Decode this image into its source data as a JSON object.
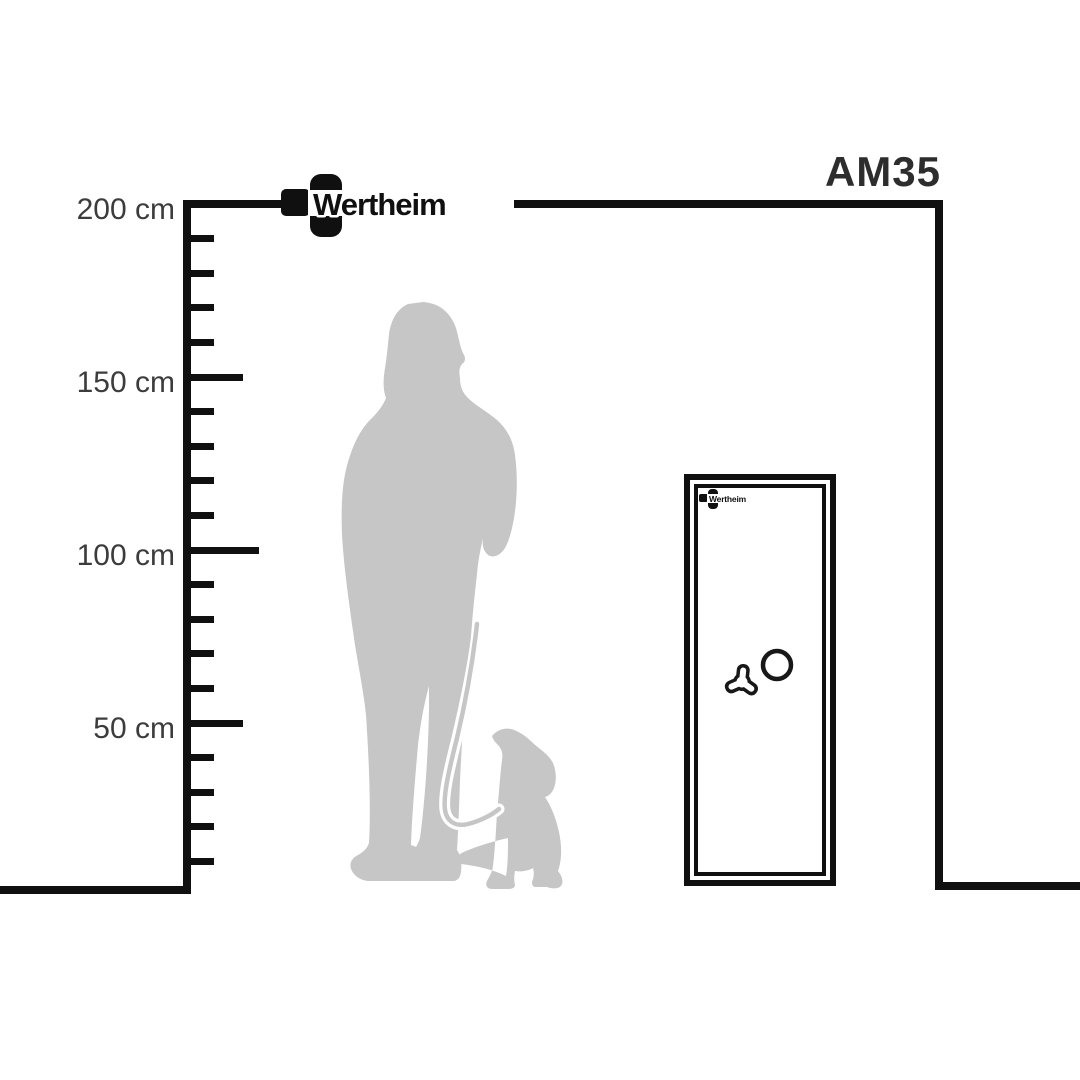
{
  "page": {
    "brand": "Wertheim",
    "description": "Size comparison diagram of Wertheim AM35 safe with woman and dog silhouette"
  },
  "safe": {
    "model": "AM35",
    "brand_label": "Wertheim"
  },
  "scale": {
    "unit": "cm",
    "min_cm": 0,
    "max_cm": 200,
    "minor_step_cm": 10,
    "major_step_cm": 50,
    "labels": [
      {
        "value": 200,
        "text": "200 cm"
      },
      {
        "value": 150,
        "text": "150 cm"
      },
      {
        "value": 100,
        "text": "100 cm"
      },
      {
        "value": 50,
        "text": "50 cm"
      }
    ]
  },
  "colors": {
    "line": "#101010",
    "label_text": "#3c3c3c",
    "model_text": "#2d2d2d",
    "silhouette": "#c6c6c6",
    "background": "#ffffff"
  }
}
